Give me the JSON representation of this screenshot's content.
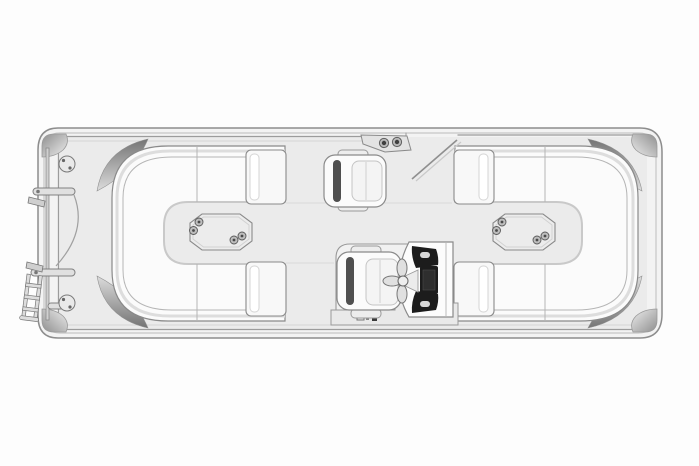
{
  "window": {
    "width": 699,
    "height": 466,
    "background": "#fdfdfd"
  },
  "diagram": {
    "subject": "pontoon-boat-floorplan-top-view",
    "orientation": "horizontal",
    "parts": {
      "lounges": [
        "bow-wraparound-lounge",
        "stern-wraparound-lounge"
      ],
      "tables": 2,
      "cup_holders_per_table": 4,
      "chairs": [
        "co-captain-swivel-chair",
        "captain-helm-chair"
      ],
      "helm": [
        "helm-console",
        "steering-wheel",
        "helm-platform"
      ],
      "bow_hardware": [
        "bow-gate-rail",
        "gate-arm-upper",
        "gate-arm-lower",
        "gate-swing-arc",
        "boarding-ladder",
        "deck-speaker-upper",
        "deck-speaker-lower"
      ],
      "top_rail": [
        "cup-holder-caddy",
        "open-side-gate"
      ],
      "corner_accents": 4,
      "corner_caps": 4
    }
  },
  "colors": {
    "hull_fill": "#f3f3f3",
    "hull_stroke": "#8d8d8d",
    "rub_rail": "#c6c6c6",
    "deck_fill": "#ebebeb",
    "seat_fill": "#fbfbfb",
    "seat_stroke": "#8a8a8a",
    "seam": "#b5b5b5",
    "soft_line": "#dddddd",
    "fin_dark": "#747474",
    "fin_light": "#dcdcdc",
    "cap_dark": "#8f8f8f",
    "cap_light": "#eeeeee",
    "table_fill": "#ececec",
    "hole_fill": "#bdbdbd",
    "dark_panel": "#1c1c1c",
    "chair_back": "#4f4f4f",
    "cushion_fill": "#f4f4f4",
    "hardware_fill": "#e0e0e0",
    "hardware_stroke": "#808080"
  }
}
